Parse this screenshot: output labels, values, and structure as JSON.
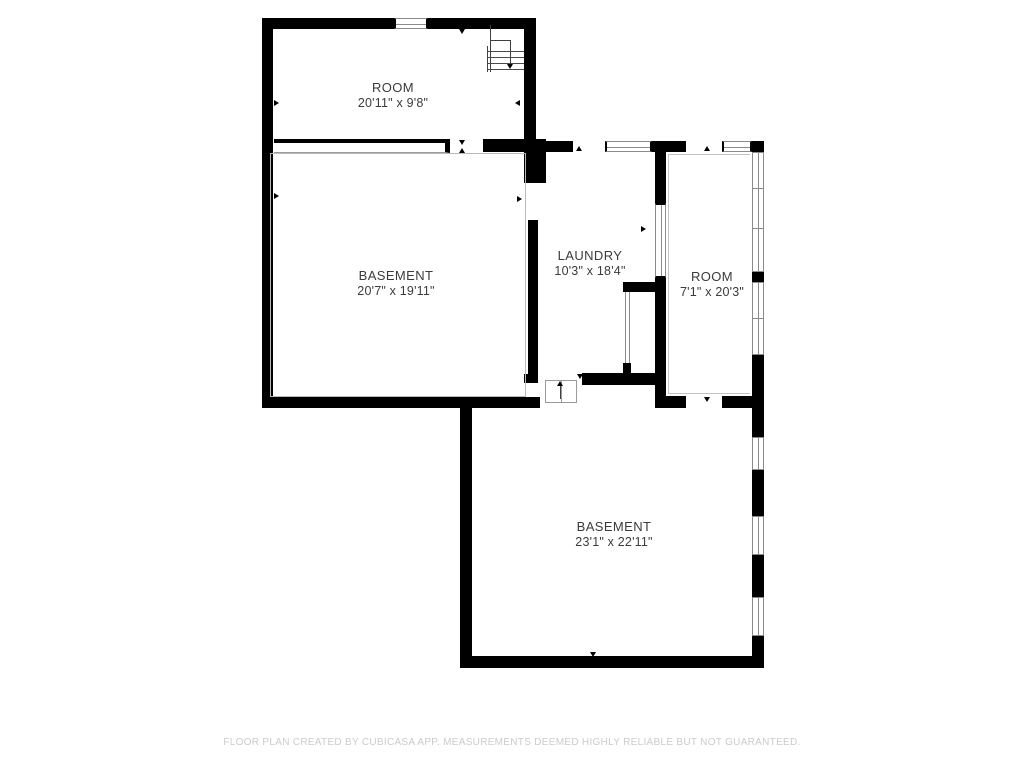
{
  "title": "Basement floor plan",
  "footer": {
    "disclaimer": "FLOOR PLAN CREATED BY CUBICASA APP. MEASUREMENTS DEEMED HIGHLY RELIABLE BUT NOT GUARANTEED."
  },
  "rooms": [
    {
      "label": "ROOM",
      "dimensions": "20'11\" x 9'8\""
    },
    {
      "label": "BASEMENT",
      "dimensions": "20'7\" x 19'11\""
    },
    {
      "label": "LAUNDRY",
      "dimensions": "10'3\" x 18'4\""
    },
    {
      "label": "ROOM",
      "dimensions": "7'1\" x 20'3\""
    },
    {
      "label": "BASEMENT",
      "dimensions": "23'1\" x 22'11\""
    }
  ],
  "colors": {
    "background": "#ffffff",
    "wall": "#000000",
    "window_frame": "#8a8a8a",
    "room_outline": "#b9b9b9",
    "label_text": "#3b3b3b",
    "disclaimer_text": "#cbcbcb"
  }
}
